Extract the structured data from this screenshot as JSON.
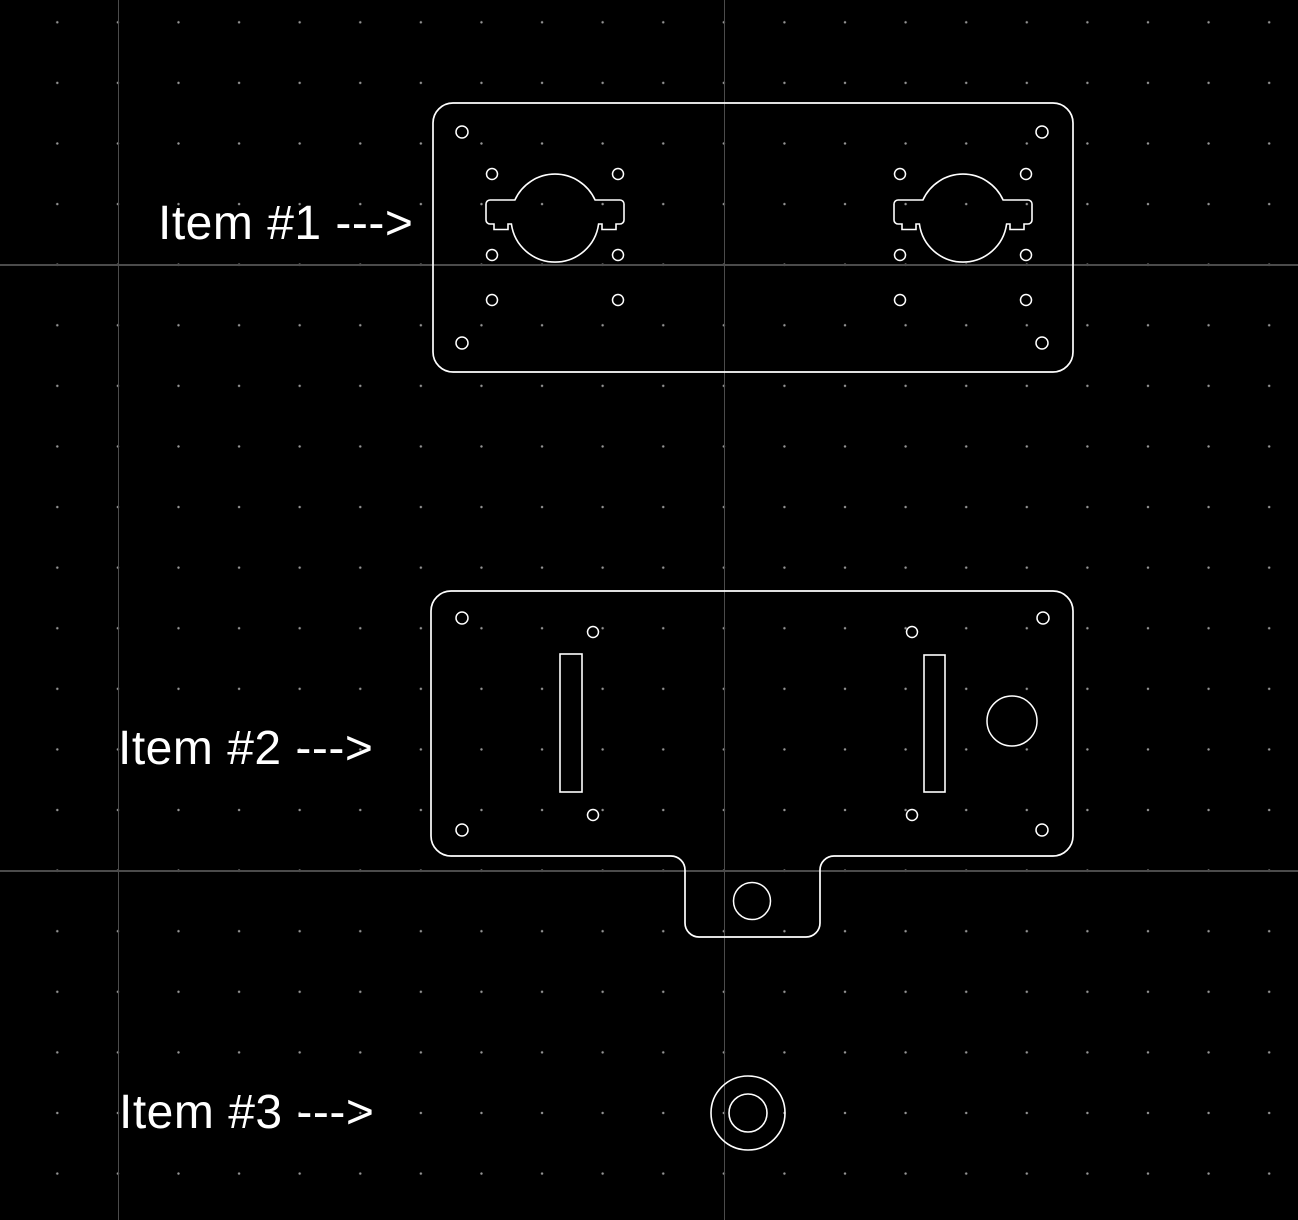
{
  "app": {
    "type": "cad-canvas",
    "background_color": "#000000",
    "geometry_color": "#ffffff",
    "grid_dot_color": "#969696",
    "grid_line_color": "#4b4b4b",
    "text_color": "#ffffff"
  },
  "canvas": {
    "width": 1298,
    "height": 1220
  },
  "grid": {
    "dot_spacing": 60.6,
    "major_vlines_x": [
      117.6,
      723.6
    ],
    "major_hlines_y": [
      264.4,
      870.4
    ]
  },
  "labels": [
    {
      "id": "item-1-label",
      "text": "Item #1 --->",
      "x": 158,
      "y": 200
    },
    {
      "id": "item-2-label",
      "text": "Item #2 --->",
      "x": 118,
      "y": 725
    },
    {
      "id": "item-3-label",
      "text": "Item #3 --->",
      "x": 119,
      "y": 1089
    }
  ],
  "drawing": {
    "paths": [
      {
        "name": "item-1-plate-outline",
        "cls": "outline",
        "d": "M 453 103 L 1053 103 A 20 20 0 0 1 1073 123 L 1073 352 A 20 20 0 0 1 1053 372 L 453 372 A 20 20 0 0 1 433 352 L 433 123 A 20 20 0 0 1 453 103 Z"
      },
      {
        "name": "item-1-motor-cutout-left",
        "cls": "cutout",
        "d": "M 490 200 L 514.9 200 A 44 44 0 0 1 595.1 200 L 620 200 A 4 4 0 0 1 624 204 L 624 220 A 4 4 0 0 1 620 224 L 616 224 L 616 229.5 L 602 229.5 L 602 224 L 598.6 224 A 44 44 0 0 1 511.4 224 L 508 224 L 508 229.5 L 494 229.5 L 494 224 L 490 224 A 4 4 0 0 1 486 220 L 486 204 A 4 4 0 0 1 490 200 Z"
      },
      {
        "name": "item-1-motor-cutout-right",
        "cls": "cutout",
        "d": "M 898 200 L 922.9 200 A 44 44 0 0 1 1003.1 200 L 1028 200 A 4 4 0 0 1 1032 204 L 1032 220 A 4 4 0 0 1 1028 224 L 1024 224 L 1024 229.5 L 1010 229.5 L 1010 224 L 1006.6 224 A 44 44 0 0 1 919.4 224 L 916 224 L 916 229.5 L 902 229.5 L 902 224 L 898 224 A 4 4 0 0 1 894 220 L 894 204 A 4 4 0 0 1 898 200 Z"
      },
      {
        "name": "item-2-plate-outline-with-tab",
        "cls": "outline",
        "d": "M 451 591 L 1053 591 A 20 20 0 0 1 1073 611 L 1073 836 A 20 20 0 0 1 1053 856 L 834 856 A 14 14 0 0 0 820 870 L 820 923 A 14 14 0 0 1 806 937 L 699 937 A 14 14 0 0 1 685 923 L 685 870 A 14 14 0 0 0 671 856 L 451 856 A 20 20 0 0 1 431 836 L 431 611 A 20 20 0 0 1 451 591 Z"
      }
    ],
    "rects": [
      {
        "name": "item-2-slot-left",
        "cls": "cutout",
        "x": 560,
        "y": 654,
        "w": 22,
        "h": 138
      },
      {
        "name": "item-2-slot-right",
        "cls": "cutout",
        "x": 924,
        "y": 655,
        "w": 21,
        "h": 137
      }
    ],
    "circles": [
      {
        "name": "item-1-corner-hole",
        "cls": "hole",
        "cx": 462,
        "cy": 132,
        "r": 6
      },
      {
        "name": "item-1-corner-hole",
        "cls": "hole",
        "cx": 1042,
        "cy": 132,
        "r": 6
      },
      {
        "name": "item-1-corner-hole",
        "cls": "hole",
        "cx": 462,
        "cy": 343,
        "r": 6
      },
      {
        "name": "item-1-corner-hole",
        "cls": "hole",
        "cx": 1042,
        "cy": 343,
        "r": 6
      },
      {
        "name": "item-1-mount-hole",
        "cls": "hole",
        "cx": 492,
        "cy": 174,
        "r": 5.5
      },
      {
        "name": "item-1-mount-hole",
        "cls": "hole",
        "cx": 618,
        "cy": 174,
        "r": 5.5
      },
      {
        "name": "item-1-mount-hole",
        "cls": "hole",
        "cx": 492,
        "cy": 255,
        "r": 5.5
      },
      {
        "name": "item-1-mount-hole",
        "cls": "hole",
        "cx": 618,
        "cy": 255,
        "r": 5.5
      },
      {
        "name": "item-1-mount-hole",
        "cls": "hole",
        "cx": 492,
        "cy": 300,
        "r": 5.5
      },
      {
        "name": "item-1-mount-hole",
        "cls": "hole",
        "cx": 618,
        "cy": 300,
        "r": 5.5
      },
      {
        "name": "item-1-mount-hole",
        "cls": "hole",
        "cx": 900,
        "cy": 174,
        "r": 5.5
      },
      {
        "name": "item-1-mount-hole",
        "cls": "hole",
        "cx": 1026,
        "cy": 174,
        "r": 5.5
      },
      {
        "name": "item-1-mount-hole",
        "cls": "hole",
        "cx": 900,
        "cy": 255,
        "r": 5.5
      },
      {
        "name": "item-1-mount-hole",
        "cls": "hole",
        "cx": 1026,
        "cy": 255,
        "r": 5.5
      },
      {
        "name": "item-1-mount-hole",
        "cls": "hole",
        "cx": 900,
        "cy": 300,
        "r": 5.5
      },
      {
        "name": "item-1-mount-hole",
        "cls": "hole",
        "cx": 1026,
        "cy": 300,
        "r": 5.5
      },
      {
        "name": "item-2-corner-hole",
        "cls": "hole",
        "cx": 462,
        "cy": 618,
        "r": 6
      },
      {
        "name": "item-2-corner-hole",
        "cls": "hole",
        "cx": 1043,
        "cy": 618,
        "r": 6
      },
      {
        "name": "item-2-corner-hole",
        "cls": "hole",
        "cx": 462,
        "cy": 830,
        "r": 6
      },
      {
        "name": "item-2-corner-hole",
        "cls": "hole",
        "cx": 1042,
        "cy": 830,
        "r": 6
      },
      {
        "name": "item-2-inner-hole",
        "cls": "hole",
        "cx": 593,
        "cy": 632,
        "r": 5.5
      },
      {
        "name": "item-2-inner-hole",
        "cls": "hole",
        "cx": 912,
        "cy": 632,
        "r": 5.5
      },
      {
        "name": "item-2-inner-hole",
        "cls": "hole",
        "cx": 593,
        "cy": 815,
        "r": 5.5
      },
      {
        "name": "item-2-inner-hole",
        "cls": "hole",
        "cx": 912,
        "cy": 815,
        "r": 5.5
      },
      {
        "name": "item-2-large-hole",
        "cls": "hole",
        "cx": 1012,
        "cy": 721,
        "r": 25
      },
      {
        "name": "item-2-tab-hole",
        "cls": "hole",
        "cx": 752,
        "cy": 901,
        "r": 18.5
      },
      {
        "name": "item-3-washer-outer",
        "cls": "cutout",
        "cx": 748,
        "cy": 1113,
        "r": 37
      },
      {
        "name": "item-3-washer-inner",
        "cls": "cutout",
        "cx": 748,
        "cy": 1113,
        "r": 19
      }
    ]
  }
}
